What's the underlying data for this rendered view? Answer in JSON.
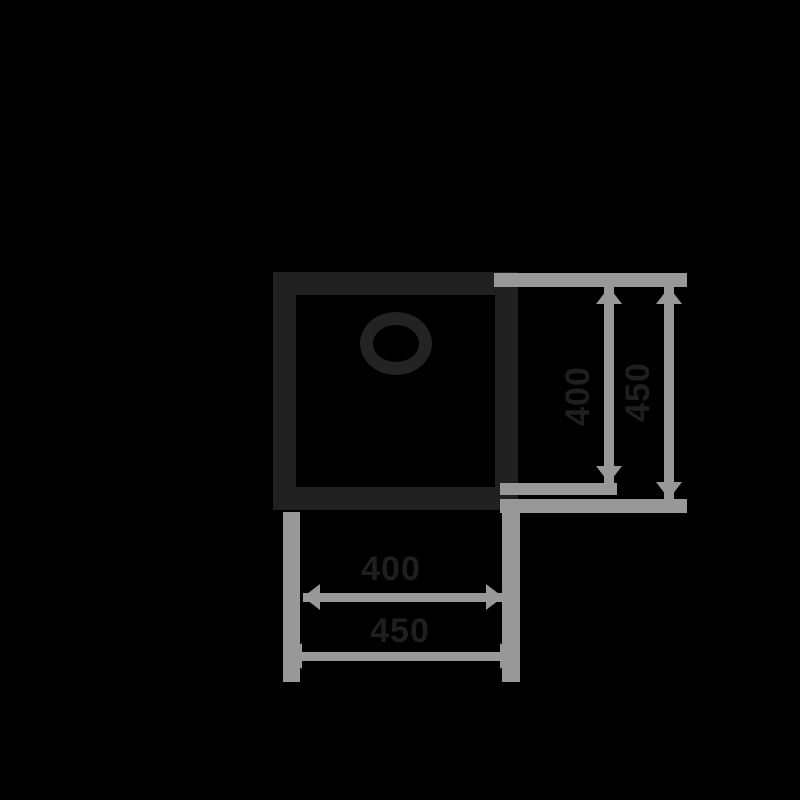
{
  "diagram": {
    "type": "product-dimension-drawing",
    "subject": "square sink bowl top view with drain",
    "colors": {
      "background": "#000000",
      "outline_stroke": "#212121",
      "dimension_lines": "#989898",
      "dimension_text": "#1f1f1f"
    },
    "dimensions": {
      "right_inner": {
        "label": "400",
        "orientation": "vertical"
      },
      "right_outer": {
        "label": "450",
        "orientation": "vertical"
      },
      "bottom_inner": {
        "label": "400",
        "orientation": "horizontal"
      },
      "bottom_outer": {
        "label": "450",
        "orientation": "horizontal"
      }
    }
  }
}
